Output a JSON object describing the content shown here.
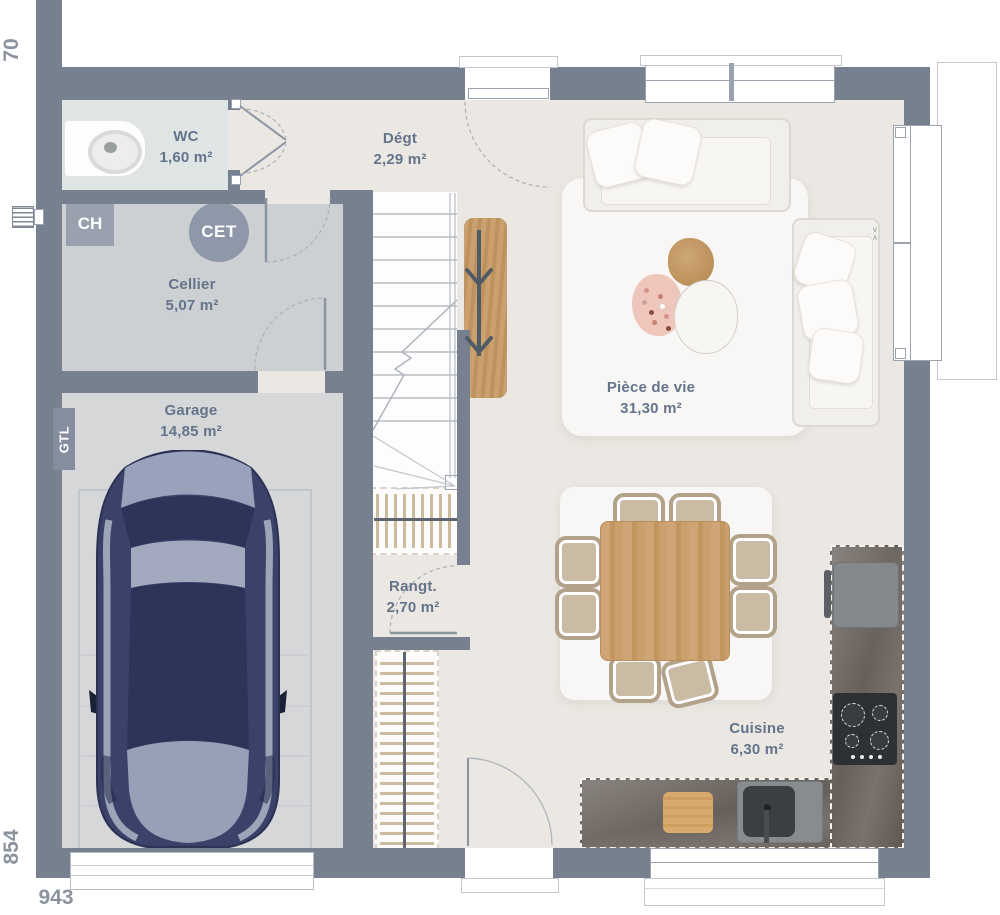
{
  "plan": {
    "title": "Plan rez-de-chaussée",
    "rooms": [
      {
        "id": "wc",
        "name": "WC",
        "area": "1,60 m²"
      },
      {
        "id": "degagement",
        "name": "Dégt",
        "area": "2,29 m²"
      },
      {
        "id": "cellier",
        "name": "Cellier",
        "area": "5,07 m²"
      },
      {
        "id": "garage",
        "name": "Garage",
        "area": "14,85 m²"
      },
      {
        "id": "piece_de_vie",
        "name": "Pièce de vie",
        "area": "31,30 m²"
      },
      {
        "id": "rangement",
        "name": "Rangt.",
        "area": "2,70 m²"
      },
      {
        "id": "cuisine",
        "name": "Cuisine",
        "area": "6,30 m²"
      }
    ],
    "annotations": {
      "ch": "CH",
      "cet": "CET",
      "gtl": "GTL",
      "window_mark_down": "∨",
      "window_mark_up": "∧"
    },
    "dimensions": {
      "top_left": "70",
      "left": "854",
      "bottom": "943"
    },
    "colors": {
      "wall": "#76808f",
      "floor_main": "#ebe7e2",
      "floor_wc": "#dfe5e5",
      "floor_cellier": "#cdd0d2",
      "floor_garage": "#d6d7d8",
      "wood": "#c9a06f",
      "car_body": "#3a4269",
      "counter_stone": "#6b645e",
      "label_text": "#64748a",
      "dimension_text": "#8b939f"
    },
    "furniture": [
      "car",
      "sofa",
      "corner-sofa",
      "coffee-tables",
      "dining-table",
      "dining-chairs",
      "kitchen-counter",
      "fridge",
      "hob",
      "sink",
      "cutting-board",
      "console",
      "vanity",
      "wardrobe-hanging",
      "wardrobe-shelves",
      "staircase"
    ]
  }
}
